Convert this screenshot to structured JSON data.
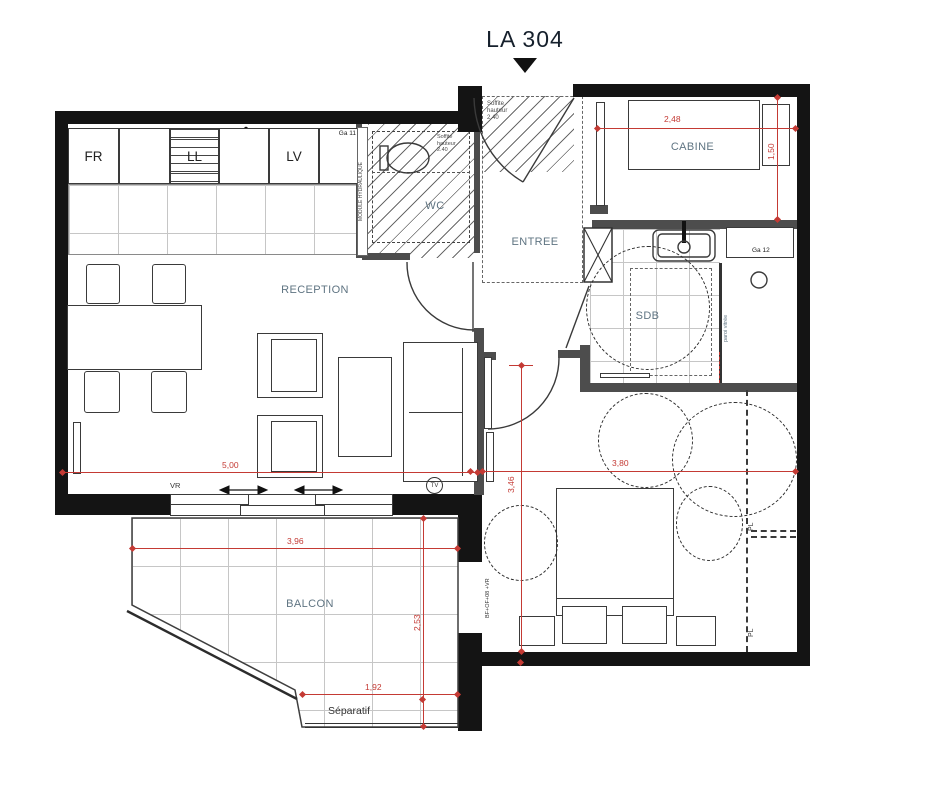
{
  "title": "LA 304",
  "rooms": {
    "reception": "RECEPTION",
    "wc": "WC",
    "entree": "ENTREE",
    "cabine": "CABINE",
    "sdb": "SDB",
    "chambre": "CHAMBRE01",
    "balcon": "BALCON"
  },
  "kitchen": {
    "fridge": "FR",
    "washer": "LL",
    "dishwasher": "LV"
  },
  "ducts": {
    "ga11": "Ga 11",
    "ga12": "Ga 12"
  },
  "annotations": {
    "module_hydraulique": "MODULE HYDRAULIQUE",
    "soffite": "Soffite hauteur 2.40",
    "paroi_vitree": "paroi vitrée",
    "vr": "VR",
    "tv": "TV",
    "separatif": "Séparatif",
    "balcony_door_spec": "BF+OF+08 +VR",
    "pl": "PL"
  },
  "dimensions": {
    "cabine_width": "2,48",
    "cabine_depth": "1,50",
    "reception_width": "5,00",
    "chambre_width": "3,80",
    "chambre_depth": "3,46",
    "balcon_width": "3,96",
    "balcon_depth": "2,53",
    "separatif_width": "1,92"
  },
  "colors": {
    "wall": "#141414",
    "partition": "#4d4d4d",
    "dimension": "#c43a34",
    "room_label": "#5f7482",
    "hatch": "#6a6a6a"
  }
}
